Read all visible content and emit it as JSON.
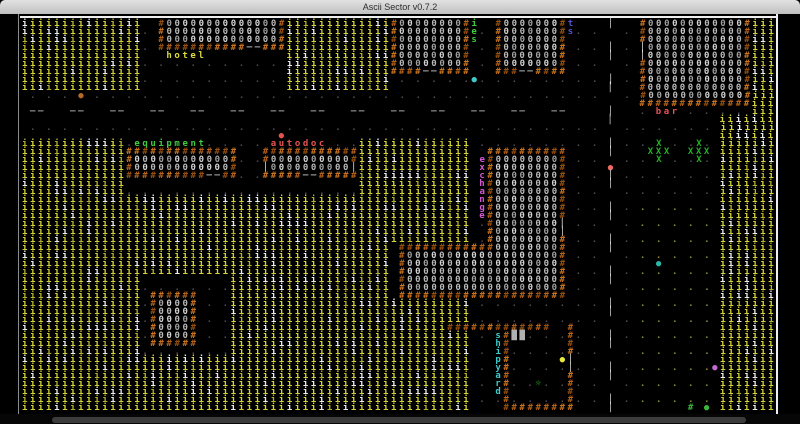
{
  "window": {
    "title": "Ascii Sector v0.7.2"
  },
  "grid": {
    "cols": 94,
    "rows": 49,
    "cell_px": 8,
    "offset_x": 22,
    "offset_y": 6
  },
  "palette": {
    "dot": "#4b4b55",
    "debris": "#8e8e3c",
    "dash": "#dcdcdc",
    "door": "#e9e9e9",
    "wall0": "#b4621a",
    "wall1": "#96500f",
    "wall2": "#ca7420",
    "floor0": "#b9b9b9",
    "floor1": "#d2d2d2",
    "floor2": "#9f9f9f",
    "tree0": "#d5d23a",
    "tree1": "#ececec",
    "tree2": "#b5b22c",
    "lbl_yellow": "#dbdb3e",
    "lbl_green": "#3ecb3e",
    "lbl_red": "#e65252",
    "lbl_magenta": "#d45ad4",
    "lbl_cyan": "#3fc9c9",
    "lbl_blue": "#5353d6",
    "flower": "#24b324",
    "shipgreen": "#2eb82e",
    "console": "#b0b0b0",
    "npc_orange": "#b56a2c",
    "npc_red": "#e65252",
    "npc_red2": "#ee6a62",
    "npc_cyan": "#3fc9c9",
    "npc_teal": "#2cb2a2",
    "npc_yellow": "#e8e83e",
    "npc_violet": "#c468d2",
    "npc_green": "#3cb43c"
  },
  "map": {
    "ops": [
      {
        "op": "dots",
        "x": 0,
        "y": 0,
        "w": 94,
        "h": 49,
        "c": "dot"
      },
      {
        "op": "dots",
        "x": 76,
        "y": 22,
        "w": 11,
        "h": 10,
        "c": "debris"
      },
      {
        "op": "dots",
        "x": 76,
        "y": 33,
        "w": 11,
        "h": 16,
        "c": "debris"
      },
      {
        "op": "clear",
        "x": 0,
        "y": 10,
        "w": 77,
        "h": 3
      },
      {
        "op": "hdash",
        "x": 0,
        "y": 11,
        "w": 71
      },
      {
        "op": "clear",
        "x": 72,
        "y": 0,
        "w": 3,
        "h": 49
      },
      {
        "op": "vdash",
        "x": 73,
        "y": 0,
        "h": 49
      },
      {
        "op": "trees",
        "x": 0,
        "y": 0,
        "w": 15,
        "h": 9
      },
      {
        "op": "trees",
        "x": 33,
        "y": 0,
        "w": 13,
        "h": 9
      },
      {
        "op": "trees",
        "x": 0,
        "y": 15,
        "w": 13,
        "h": 7
      },
      {
        "op": "trees",
        "x": 42,
        "y": 15,
        "w": 4,
        "h": 7
      },
      {
        "op": "trees",
        "x": 46,
        "y": 15,
        "w": 10,
        "h": 13
      },
      {
        "op": "trees",
        "x": 0,
        "y": 22,
        "w": 46,
        "h": 13
      },
      {
        "op": "trees",
        "x": 0,
        "y": 35,
        "w": 56,
        "h": 14
      },
      {
        "op": "trees",
        "x": 91,
        "y": 0,
        "w": 3,
        "h": 12
      },
      {
        "op": "trees",
        "x": 87,
        "y": 12,
        "w": 7,
        "h": 37
      },
      {
        "op": "clear",
        "x": 15,
        "y": 32,
        "w": 11,
        "h": 10
      },
      {
        "op": "dots",
        "x": 15,
        "y": 32,
        "w": 11,
        "h": 10,
        "c": "dot"
      },
      {
        "op": "vwall",
        "x": 17,
        "y": 0,
        "h": 3
      },
      {
        "op": "vwall",
        "x": 32,
        "y": 0,
        "h": 3
      },
      {
        "op": "floor",
        "x": 18,
        "y": 0,
        "w": 14,
        "h": 3
      },
      {
        "op": "hwall",
        "x": 17,
        "y": 3,
        "w": 16
      },
      {
        "op": "cell",
        "x": 28,
        "y": 3,
        "ch": "─",
        "c": "door"
      },
      {
        "op": "cell",
        "x": 29,
        "y": 3,
        "ch": "─",
        "c": "door"
      },
      {
        "op": "text",
        "x": 18,
        "y": 4,
        "t": "hotel",
        "c": "lbl_yellow"
      },
      {
        "op": "vwall",
        "x": 46,
        "y": 0,
        "h": 6
      },
      {
        "op": "vwall",
        "x": 55,
        "y": 0,
        "h": 6
      },
      {
        "op": "floor",
        "x": 47,
        "y": 0,
        "w": 8,
        "h": 6
      },
      {
        "op": "hwall",
        "x": 46,
        "y": 6,
        "w": 10
      },
      {
        "op": "cell",
        "x": 50,
        "y": 6,
        "ch": "─",
        "c": "door"
      },
      {
        "op": "cell",
        "x": 51,
        "y": 6,
        "ch": "─",
        "c": "door"
      },
      {
        "op": "vtext",
        "x": 56,
        "y": 0,
        "t": "ies",
        "c": "lbl_green"
      },
      {
        "op": "vwall",
        "x": 59,
        "y": 0,
        "h": 6
      },
      {
        "op": "vwall",
        "x": 67,
        "y": 0,
        "h": 6
      },
      {
        "op": "floor",
        "x": 60,
        "y": 0,
        "w": 7,
        "h": 6
      },
      {
        "op": "hwall",
        "x": 59,
        "y": 6,
        "w": 9
      },
      {
        "op": "cell",
        "x": 62,
        "y": 6,
        "ch": "─",
        "c": "door"
      },
      {
        "op": "cell",
        "x": 63,
        "y": 6,
        "ch": "─",
        "c": "door"
      },
      {
        "op": "vtext",
        "x": 68,
        "y": 0,
        "t": "ts",
        "c": "lbl_blue"
      },
      {
        "op": "vwall",
        "x": 77,
        "y": 0,
        "h": 10
      },
      {
        "op": "vwall",
        "x": 90,
        "y": 0,
        "h": 10
      },
      {
        "op": "floor",
        "x": 78,
        "y": 0,
        "w": 12,
        "h": 10
      },
      {
        "op": "hwall",
        "x": 77,
        "y": 10,
        "w": 14
      },
      {
        "op": "cell",
        "x": 77,
        "y": 3,
        "ch": "│",
        "c": "door"
      },
      {
        "op": "cell",
        "x": 77,
        "y": 4,
        "ch": "│",
        "c": "door"
      },
      {
        "op": "text",
        "x": 79,
        "y": 11,
        "t": "bar",
        "c": "lbl_red"
      },
      {
        "op": "hwall",
        "x": 13,
        "y": 16,
        "w": 14
      },
      {
        "op": "vwall",
        "x": 13,
        "y": 17,
        "h": 2
      },
      {
        "op": "vwall",
        "x": 26,
        "y": 17,
        "h": 2
      },
      {
        "op": "floor",
        "x": 14,
        "y": 17,
        "w": 12,
        "h": 2
      },
      {
        "op": "hwall",
        "x": 13,
        "y": 19,
        "w": 14
      },
      {
        "op": "cell",
        "x": 23,
        "y": 19,
        "ch": "─",
        "c": "door"
      },
      {
        "op": "cell",
        "x": 24,
        "y": 19,
        "ch": "─",
        "c": "door"
      },
      {
        "op": "text",
        "x": 14,
        "y": 15,
        "t": "equipment",
        "c": "lbl_green"
      },
      {
        "op": "hwall",
        "x": 30,
        "y": 16,
        "w": 12
      },
      {
        "op": "vwall",
        "x": 30,
        "y": 17,
        "h": 2
      },
      {
        "op": "vwall",
        "x": 41,
        "y": 17,
        "h": 2
      },
      {
        "op": "floor",
        "x": 31,
        "y": 17,
        "w": 10,
        "h": 2
      },
      {
        "op": "hwall",
        "x": 30,
        "y": 19,
        "w": 12
      },
      {
        "op": "cell",
        "x": 35,
        "y": 19,
        "ch": "─",
        "c": "door"
      },
      {
        "op": "cell",
        "x": 36,
        "y": 19,
        "ch": "─",
        "c": "door"
      },
      {
        "op": "cell",
        "x": 30,
        "y": 18,
        "ch": "│",
        "c": "door"
      },
      {
        "op": "cell",
        "x": 41,
        "y": 18,
        "ch": "│",
        "c": "door"
      },
      {
        "op": "text",
        "x": 31,
        "y": 15,
        "t": "autodoc",
        "c": "lbl_red"
      },
      {
        "op": "hwall",
        "x": 47,
        "y": 28,
        "w": 12
      },
      {
        "op": "hwall",
        "x": 47,
        "y": 34,
        "w": 21
      },
      {
        "op": "vwall",
        "x": 47,
        "y": 29,
        "h": 5
      },
      {
        "op": "vwall",
        "x": 67,
        "y": 29,
        "h": 5
      },
      {
        "op": "floor",
        "x": 48,
        "y": 29,
        "w": 19,
        "h": 5
      },
      {
        "op": "hwall",
        "x": 58,
        "y": 16,
        "w": 10
      },
      {
        "op": "vwall",
        "x": 58,
        "y": 17,
        "h": 12
      },
      {
        "op": "vwall",
        "x": 67,
        "y": 17,
        "h": 12
      },
      {
        "op": "floor",
        "x": 59,
        "y": 17,
        "w": 8,
        "h": 12
      },
      {
        "op": "cell",
        "x": 67,
        "y": 25,
        "ch": "│",
        "c": "door"
      },
      {
        "op": "cell",
        "x": 67,
        "y": 26,
        "ch": "│",
        "c": "door"
      },
      {
        "op": "vtext",
        "x": 57,
        "y": 17,
        "t": "exchange",
        "c": "lbl_magenta"
      },
      {
        "op": "hwall",
        "x": 16,
        "y": 34,
        "w": 6
      },
      {
        "op": "vwall",
        "x": 16,
        "y": 35,
        "h": 5
      },
      {
        "op": "vwall",
        "x": 21,
        "y": 35,
        "h": 5
      },
      {
        "op": "floor",
        "x": 17,
        "y": 35,
        "w": 4,
        "h": 5
      },
      {
        "op": "hwall",
        "x": 16,
        "y": 40,
        "w": 6
      },
      {
        "op": "hwall",
        "x": 53,
        "y": 38,
        "w": 13
      },
      {
        "op": "cell",
        "x": 68,
        "y": 38,
        "ch": "#",
        "c": "wall0"
      },
      {
        "op": "vwall",
        "x": 60,
        "y": 39,
        "h": 10
      },
      {
        "op": "vwall",
        "x": 68,
        "y": 39,
        "h": 10
      },
      {
        "op": "hwall",
        "x": 60,
        "y": 48,
        "w": 9
      },
      {
        "op": "cell",
        "x": 68,
        "y": 42,
        "ch": "│",
        "c": "door"
      },
      {
        "op": "cell",
        "x": 68,
        "y": 43,
        "ch": "│",
        "c": "door"
      },
      {
        "op": "vtext",
        "x": 59,
        "y": 39,
        "t": "shipyard",
        "c": "lbl_cyan"
      },
      {
        "op": "cell",
        "x": 61,
        "y": 39,
        "ch": "█",
        "c": "console"
      },
      {
        "op": "cell",
        "x": 62,
        "y": 39,
        "ch": "█",
        "c": "console"
      },
      {
        "op": "cell",
        "x": 64,
        "y": 45,
        "ch": "☼",
        "c": "shipgreen"
      },
      {
        "op": "cell",
        "x": 79,
        "y": 15,
        "ch": "X",
        "c": "flower"
      },
      {
        "op": "cell",
        "x": 78,
        "y": 16,
        "ch": "X",
        "c": "flower"
      },
      {
        "op": "cell",
        "x": 79,
        "y": 16,
        "ch": "X",
        "c": "flower"
      },
      {
        "op": "cell",
        "x": 80,
        "y": 16,
        "ch": "X",
        "c": "flower"
      },
      {
        "op": "cell",
        "x": 79,
        "y": 17,
        "ch": "X",
        "c": "flower"
      },
      {
        "op": "cell",
        "x": 84,
        "y": 15,
        "ch": "X",
        "c": "flower"
      },
      {
        "op": "cell",
        "x": 83,
        "y": 16,
        "ch": "X",
        "c": "flower"
      },
      {
        "op": "cell",
        "x": 84,
        "y": 16,
        "ch": "X",
        "c": "flower"
      },
      {
        "op": "cell",
        "x": 85,
        "y": 16,
        "ch": "X",
        "c": "flower"
      },
      {
        "op": "cell",
        "x": 84,
        "y": 17,
        "ch": "X",
        "c": "flower"
      },
      {
        "op": "cell",
        "x": 83,
        "y": 48,
        "ch": "#",
        "c": "npc_green"
      },
      {
        "op": "cell",
        "x": 85,
        "y": 48,
        "ch": "●",
        "c": "npc_green"
      },
      {
        "op": "cell",
        "x": 7,
        "y": 9,
        "ch": "●",
        "c": "npc_orange"
      },
      {
        "op": "cell",
        "x": 32,
        "y": 14,
        "ch": "●",
        "c": "npc_red"
      },
      {
        "op": "cell",
        "x": 73,
        "y": 18,
        "ch": "●",
        "c": "npc_red2"
      },
      {
        "op": "cell",
        "x": 56,
        "y": 7,
        "ch": "●",
        "c": "npc_cyan"
      },
      {
        "op": "cell",
        "x": 79,
        "y": 30,
        "ch": "●",
        "c": "npc_teal"
      },
      {
        "op": "cell",
        "x": 67,
        "y": 42,
        "ch": "●",
        "c": "npc_yellow"
      },
      {
        "op": "cell",
        "x": 86,
        "y": 43,
        "ch": "●",
        "c": "npc_violet"
      }
    ]
  }
}
